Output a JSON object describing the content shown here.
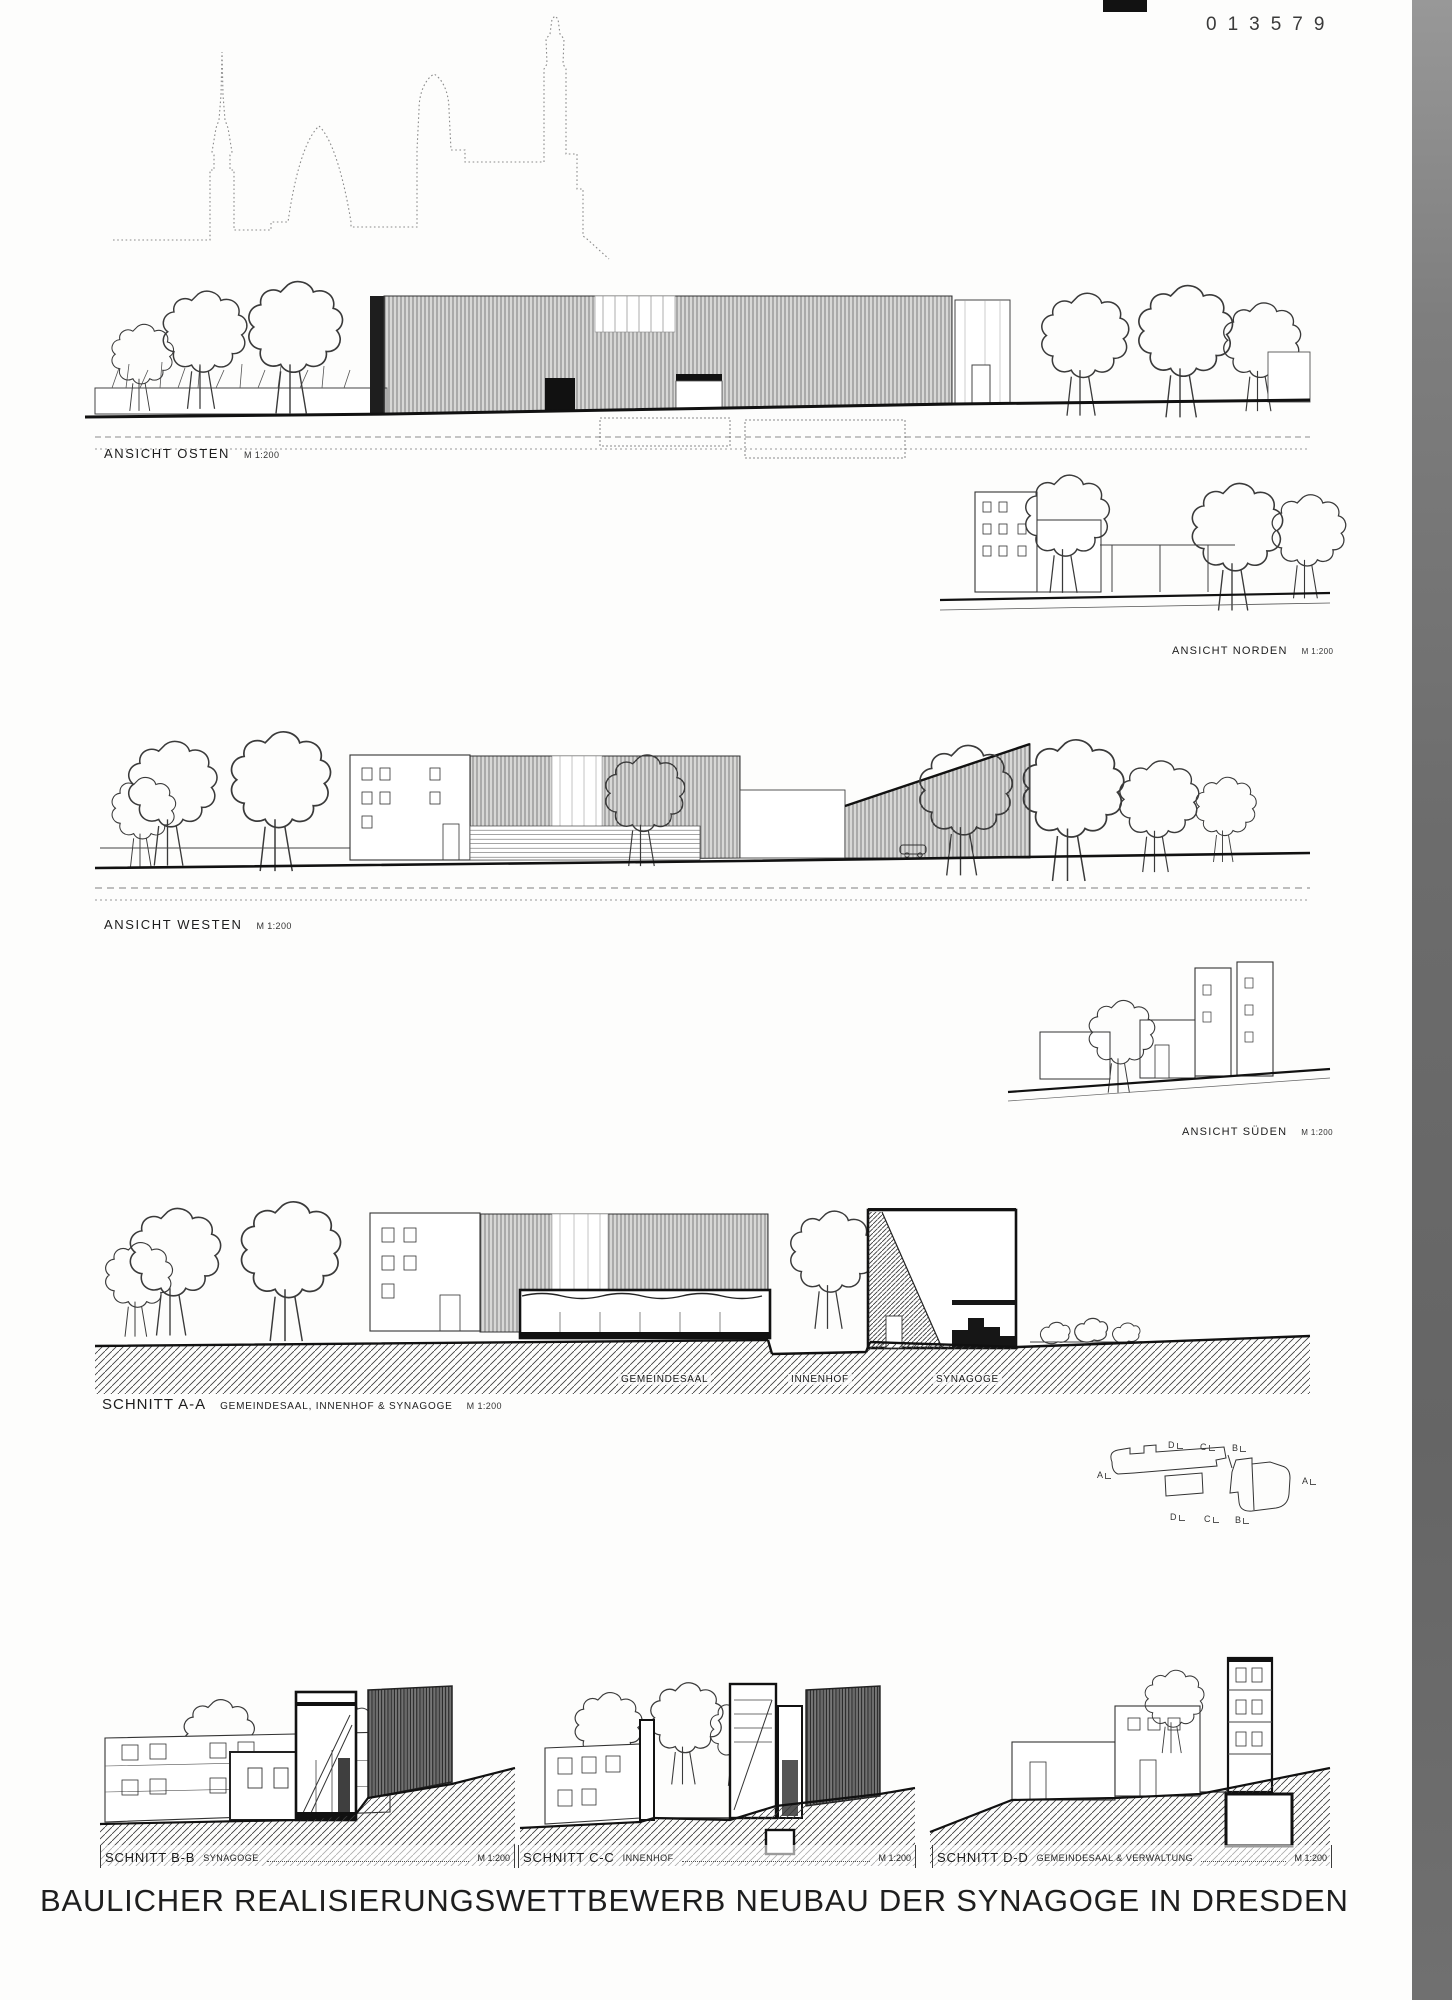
{
  "page": {
    "number": "013579",
    "title": "BAULICHER REALISIERUNGSWETTBEWERB NEUBAU DER SYNAGOGE IN DRESDEN"
  },
  "labels": {
    "osten": {
      "name": "ANSICHT OSTEN",
      "scale": "M 1:200"
    },
    "norden": {
      "name": "ANSICHT NORDEN",
      "scale": "M 1:200"
    },
    "westen": {
      "name": "ANSICHT WESTEN",
      "scale": "M 1:200"
    },
    "sueden": {
      "name": "ANSICHT SÜDEN",
      "scale": "M 1:200"
    },
    "schnitt_aa": {
      "name": "SCHNITT A-A",
      "sub": "GEMEINDESAAL, INNENHOF & SYNAGOGE",
      "scale": "M 1:200"
    },
    "schnitt_bb": {
      "name": "SCHNITT B-B",
      "sub": "SYNAGOGE",
      "scale": "M 1:200"
    },
    "schnitt_cc": {
      "name": "SCHNITT C-C",
      "sub": "INNENHOF",
      "scale": "M 1:200"
    },
    "schnitt_dd": {
      "name": "SCHNITT D-D",
      "sub": "GEMEINDESAAL & VERWALTUNG",
      "scale": "M 1:200"
    }
  },
  "section_aa_zones": [
    "GEMEINDESAAL",
    "INNENHOF",
    "SYNAGOGE"
  ],
  "key_plan": {
    "top": [
      "D",
      "C",
      "B"
    ],
    "left": "A",
    "right": "A",
    "bottom": [
      "D",
      "C",
      "B"
    ]
  },
  "colors": {
    "ink": "#2a2a2a",
    "scan_edge": "#6e6e6e",
    "paper": "#fdfdfc"
  }
}
